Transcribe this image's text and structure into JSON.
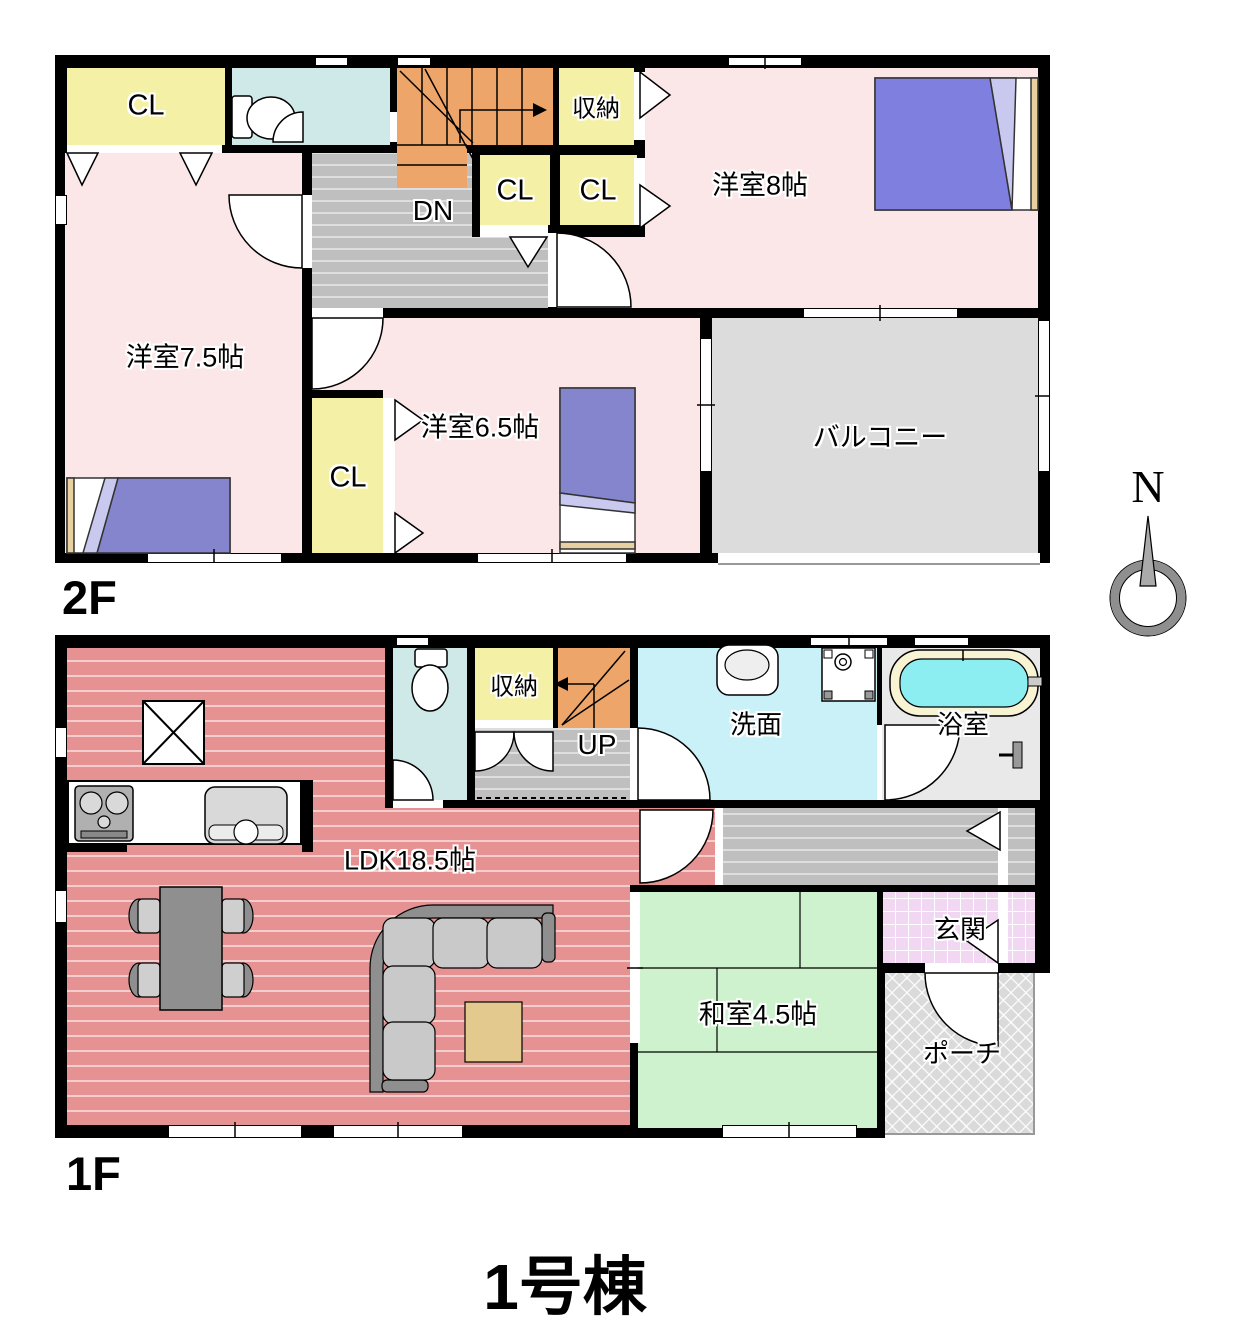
{
  "title": "1号棟",
  "compass": {
    "north": "N"
  },
  "colors": {
    "wall": "#000000",
    "western_room": "#fbe7e7",
    "closet": "#f4f0a6",
    "stairs": "#eda56a",
    "hall": "#bfbfbf",
    "balcony": "#dcdcdc",
    "ldk_floor": "#e69292",
    "toilet_room": "#cfe9e9",
    "washroom": "#c9f1f7",
    "bath_water": "#8deef1",
    "tatami": "#cdf2cd",
    "entrance_tile": "#f2d7f3",
    "porch": "#dadada",
    "bed": "#7f7fe0"
  },
  "floor2": {
    "label": "2F",
    "rooms": {
      "closet_tl": "CL",
      "storage": "収納",
      "closet_a": "CL",
      "closet_b": "CL",
      "western8": "洋室8帖",
      "western75": "洋室7.5帖",
      "western65": "洋室6.5帖",
      "closet65": "CL",
      "balcony": "バルコニー",
      "stairs_dn": "DN"
    }
  },
  "floor1": {
    "label": "1F",
    "rooms": {
      "storage": "収納",
      "stairs_up": "UP",
      "washroom": "洗面",
      "bathroom": "浴室",
      "ldk": "LDK18.5帖",
      "japanese_room": "和室4.5帖",
      "entrance": "玄関",
      "porch": "ポーチ"
    }
  }
}
